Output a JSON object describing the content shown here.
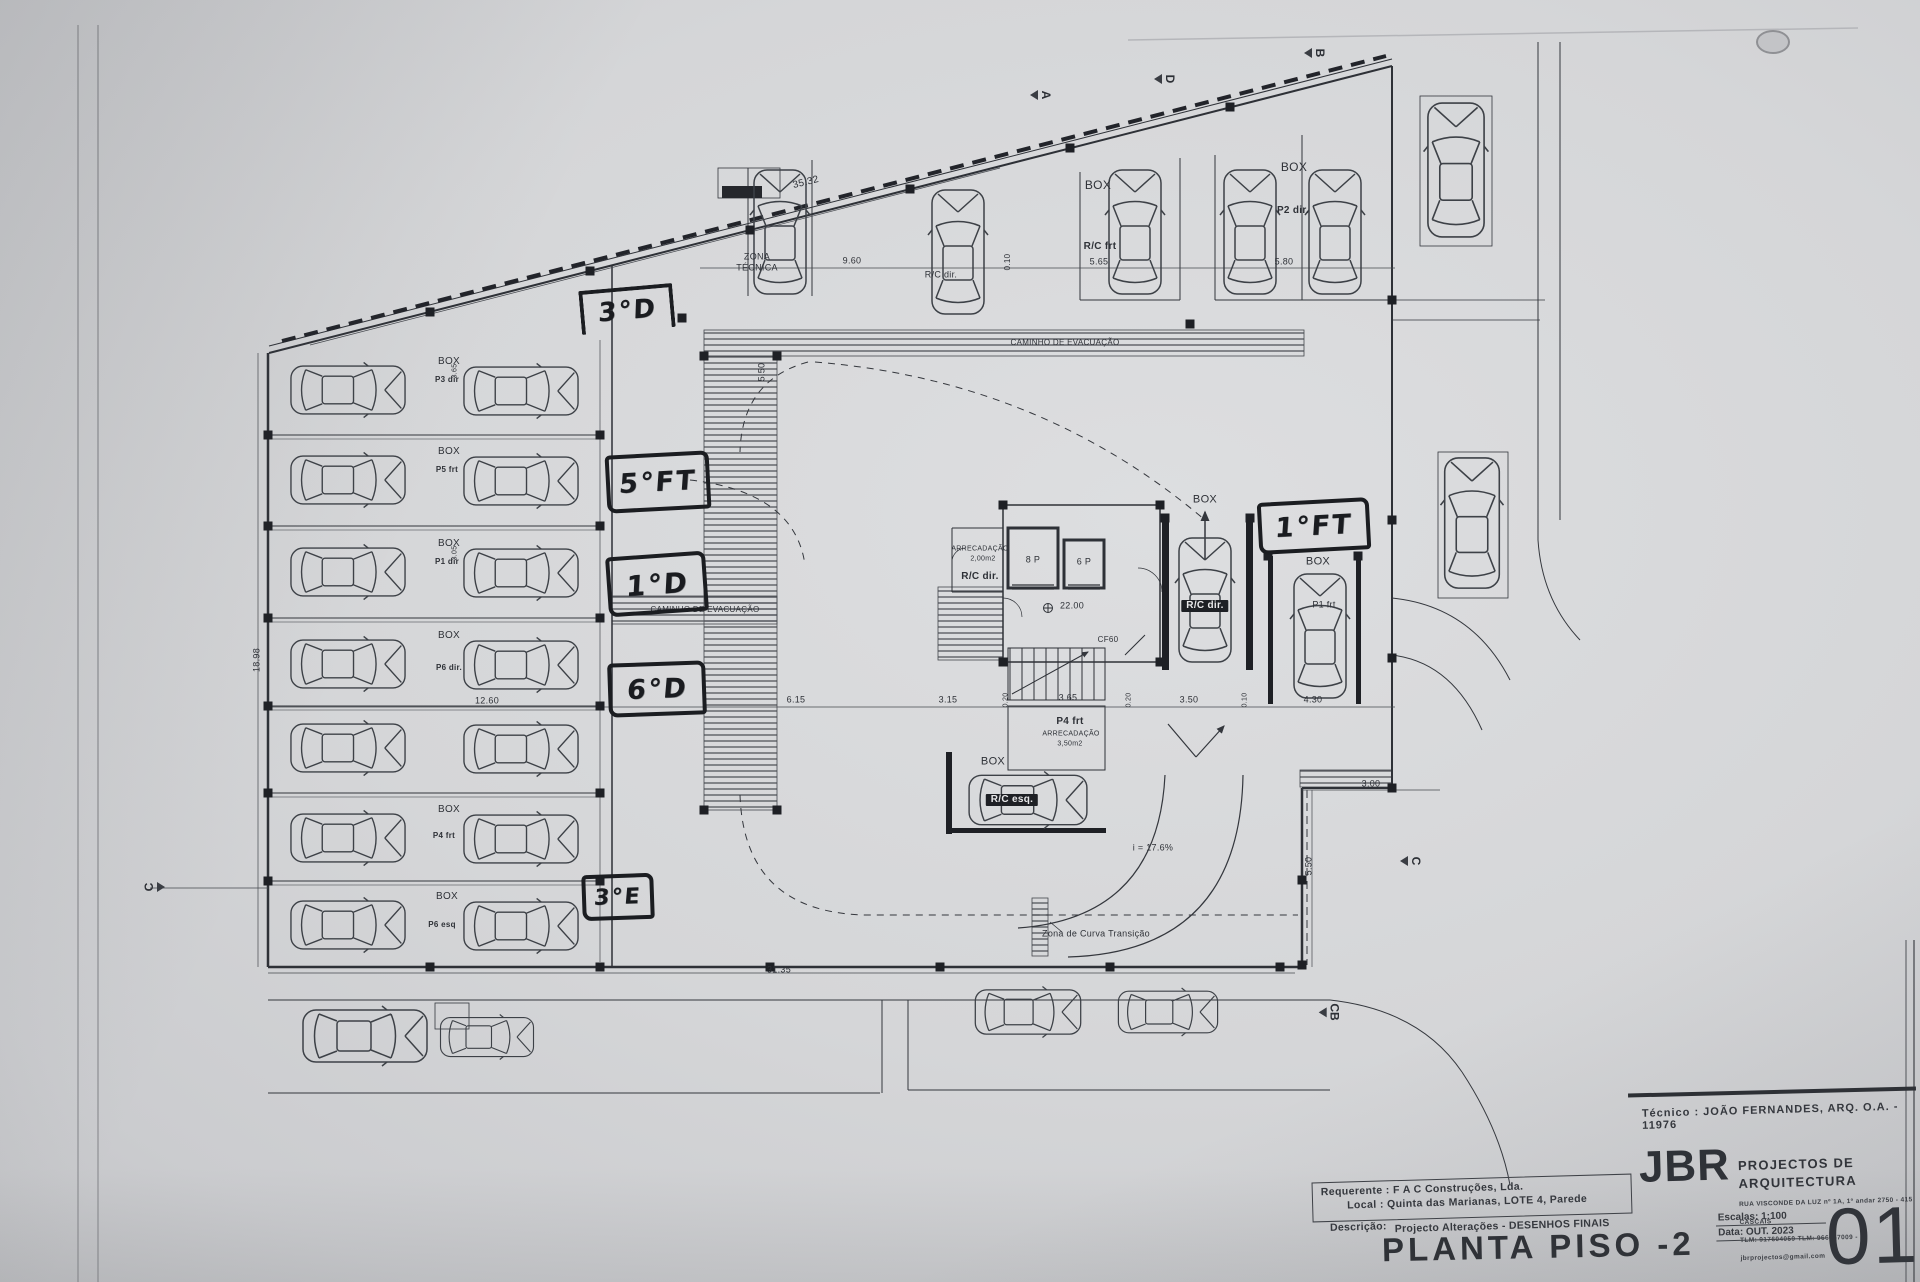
{
  "title_block": {
    "tecnico": "Técnico : JOÃO FERNANDES, ARQ.   O.A. - 11976",
    "firm_initials": "JBR",
    "firm_name": "PROJECTOS DE ARQUITECTURA",
    "firm_address": "RUA VISCONDE DA LUZ nº 1A, 1º andar  2750 - 415  CASCAIS",
    "firm_contacts": "TLM: 917604059  TLM: 966667009 - jbrprojectos@gmail.com",
    "requerente": "Requerente : F A C  Construções, Lda.",
    "local": "Local : Quinta das Marianas, LOTE 4, Parede",
    "descricao_label": "Descrição:",
    "descricao": "Projecto Alterações - DESENHOS FINAIS",
    "escala": "Escalas:  1:100",
    "data": "Data: OUT.  2023",
    "drawing_title": "PLANTA PISO -2",
    "sheet_number": "01"
  },
  "plan_labels": [
    {
      "t": "ZONA",
      "x": 757,
      "y": 257,
      "fs": 9
    },
    {
      "t": "TÉCNICA",
      "x": 757,
      "y": 268,
      "fs": 9
    },
    {
      "t": "35.32",
      "x": 806,
      "y": 183,
      "fs": 10,
      "rot": -14
    },
    {
      "t": "9.60",
      "x": 852,
      "y": 261,
      "fs": 9
    },
    {
      "t": "0.10",
      "x": 1008,
      "y": 262,
      "fs": 8,
      "rot": -90
    },
    {
      "t": "5.65",
      "x": 1099,
      "y": 262,
      "fs": 9
    },
    {
      "t": "5.80",
      "x": 1284,
      "y": 262,
      "fs": 9
    },
    {
      "t": "BOX",
      "x": 1098,
      "y": 185,
      "fs": 12
    },
    {
      "t": "R/C frt",
      "x": 1100,
      "y": 247,
      "fs": 10,
      "b": 1
    },
    {
      "t": "BOX",
      "x": 1294,
      "y": 167,
      "fs": 12
    },
    {
      "t": "P2 dir.",
      "x": 1293,
      "y": 211,
      "fs": 10,
      "b": 1
    },
    {
      "t": "R/C dir.",
      "x": 941,
      "y": 275,
      "fs": 9
    },
    {
      "t": "CAMINHO DE EVACUAÇÃO",
      "x": 1065,
      "y": 343,
      "fs": 8
    },
    {
      "t": "CAMINHO DE EVACUAÇÃO",
      "x": 705,
      "y": 610,
      "fs": 8
    },
    {
      "t": "ARRECADAÇÃO",
      "x": 980,
      "y": 549,
      "fs": 7
    },
    {
      "t": "2,00m2",
      "x": 983,
      "y": 559,
      "fs": 7
    },
    {
      "t": "R/C dir.",
      "x": 980,
      "y": 577,
      "fs": 10,
      "b": 1
    },
    {
      "t": "8 P",
      "x": 1033,
      "y": 560,
      "fs": 9
    },
    {
      "t": "6 P",
      "x": 1084,
      "y": 562,
      "fs": 9
    },
    {
      "t": "22.00",
      "x": 1072,
      "y": 606,
      "fs": 9
    },
    {
      "t": "CF60",
      "x": 1108,
      "y": 640,
      "fs": 8
    },
    {
      "t": "P4 frt",
      "x": 1070,
      "y": 722,
      "fs": 10,
      "b": 1
    },
    {
      "t": "ARRECADAÇÃO",
      "x": 1071,
      "y": 734,
      "fs": 7
    },
    {
      "t": "3,50m2",
      "x": 1070,
      "y": 744,
      "fs": 7
    },
    {
      "t": "BOX",
      "x": 993,
      "y": 762,
      "fs": 11
    },
    {
      "t": "R/C esq.",
      "x": 1012,
      "y": 800,
      "fs": 10,
      "inv": 1
    },
    {
      "t": "R/C dir.",
      "x": 1205,
      "y": 606,
      "fs": 10,
      "inv": 1
    },
    {
      "t": "BOX",
      "x": 1205,
      "y": 500,
      "fs": 11
    },
    {
      "t": "BOX",
      "x": 1318,
      "y": 562,
      "fs": 11
    },
    {
      "t": "P1 frt",
      "x": 1324,
      "y": 605,
      "fs": 9
    },
    {
      "t": "i = 17.6%",
      "x": 1153,
      "y": 848,
      "fs": 9
    },
    {
      "t": "Zona de Curva Transição",
      "x": 1096,
      "y": 934,
      "fs": 9
    },
    {
      "t": "6.15",
      "x": 796,
      "y": 700,
      "fs": 9
    },
    {
      "t": "3.15",
      "x": 948,
      "y": 700,
      "fs": 9
    },
    {
      "t": "0.20",
      "x": 1006,
      "y": 700,
      "fs": 7,
      "rot": -90
    },
    {
      "t": "3.65",
      "x": 1068,
      "y": 698,
      "fs": 9
    },
    {
      "t": "0.20",
      "x": 1129,
      "y": 700,
      "fs": 7,
      "rot": -90
    },
    {
      "t": "3.50",
      "x": 1189,
      "y": 700,
      "fs": 9
    },
    {
      "t": "0.10",
      "x": 1245,
      "y": 700,
      "fs": 7,
      "rot": -90
    },
    {
      "t": "4.30",
      "x": 1313,
      "y": 700,
      "fs": 9
    },
    {
      "t": "12.60",
      "x": 487,
      "y": 701,
      "fs": 9
    },
    {
      "t": "31.35",
      "x": 779,
      "y": 970,
      "fs": 9
    },
    {
      "t": "18.98",
      "x": 257,
      "y": 660,
      "fs": 9,
      "rot": -90
    },
    {
      "t": "5.50",
      "x": 1309,
      "y": 866,
      "fs": 9,
      "rot": -90
    },
    {
      "t": "5.50",
      "x": 762,
      "y": 372,
      "fs": 9,
      "rot": -90
    },
    {
      "t": "3.00",
      "x": 1371,
      "y": 784,
      "fs": 9
    },
    {
      "t": "BOX",
      "x": 449,
      "y": 362,
      "fs": 10
    },
    {
      "t": "BOX",
      "x": 449,
      "y": 452,
      "fs": 10
    },
    {
      "t": "BOX",
      "x": 449,
      "y": 544,
      "fs": 10
    },
    {
      "t": "BOX",
      "x": 449,
      "y": 636,
      "fs": 10
    },
    {
      "t": "BOX",
      "x": 449,
      "y": 810,
      "fs": 10
    },
    {
      "t": "BOX",
      "x": 447,
      "y": 897,
      "fs": 10
    },
    {
      "t": "P3 dir",
      "x": 447,
      "y": 380,
      "fs": 8,
      "b": 1
    },
    {
      "t": "P5 frt",
      "x": 447,
      "y": 470,
      "fs": 8,
      "b": 1
    },
    {
      "t": "P1 dir",
      "x": 447,
      "y": 562,
      "fs": 8,
      "b": 1
    },
    {
      "t": "P6 dir.",
      "x": 449,
      "y": 668,
      "fs": 8,
      "b": 1
    },
    {
      "t": "P4 frt",
      "x": 444,
      "y": 836,
      "fs": 8,
      "b": 1
    },
    {
      "t": "P6 esq",
      "x": 442,
      "y": 925,
      "fs": 8,
      "b": 1
    },
    {
      "t": "3.65",
      "x": 455,
      "y": 371,
      "fs": 7,
      "rot": -90
    },
    {
      "t": "3.05",
      "x": 455,
      "y": 553,
      "fs": 7,
      "rot": -90
    }
  ],
  "handwritten": [
    {
      "t": "3°D",
      "x": 623,
      "y": 307,
      "w": 86,
      "h": 40,
      "rot": -5,
      "style": "bars",
      "fs": 26
    },
    {
      "t": "5°FT",
      "x": 654,
      "y": 478,
      "w": 96,
      "h": 50,
      "rot": -3,
      "style": "box",
      "fs": 27
    },
    {
      "t": "1°D",
      "x": 653,
      "y": 580,
      "w": 92,
      "h": 52,
      "rot": -4,
      "style": "box",
      "fs": 28
    },
    {
      "t": "6°D",
      "x": 653,
      "y": 685,
      "w": 90,
      "h": 46,
      "rot": -2,
      "style": "box",
      "fs": 27
    },
    {
      "t": "3°E",
      "x": 614,
      "y": 893,
      "w": 64,
      "h": 38,
      "rot": -2,
      "style": "box",
      "fs": 22
    },
    {
      "t": "1°FT",
      "x": 1310,
      "y": 522,
      "w": 104,
      "h": 44,
      "rot": -3,
      "style": "box",
      "fs": 27
    }
  ],
  "section_markers": [
    {
      "t": "A",
      "x": 1044,
      "y": 96,
      "rot": 90
    },
    {
      "t": "D",
      "x": 1168,
      "y": 80,
      "rot": 90
    },
    {
      "t": "B",
      "x": 1318,
      "y": 54,
      "rot": 90
    },
    {
      "t": "C",
      "x": 157,
      "y": 888,
      "rot": -90
    },
    {
      "t": "C",
      "x": 1414,
      "y": 862,
      "rot": 90
    },
    {
      "t": "CB",
      "x": 1329,
      "y": 1013,
      "rot": 90
    }
  ],
  "cars": [
    [
      348,
      390,
      90,
      0.92
    ],
    [
      521,
      391,
      90,
      0.92
    ],
    [
      348,
      480,
      90,
      0.92
    ],
    [
      521,
      481,
      90,
      0.92
    ],
    [
      348,
      572,
      90,
      0.92
    ],
    [
      521,
      573,
      90,
      0.92
    ],
    [
      348,
      664,
      90,
      0.92
    ],
    [
      521,
      665,
      90,
      0.92
    ],
    [
      348,
      748,
      90,
      0.92
    ],
    [
      521,
      749,
      90,
      0.92
    ],
    [
      348,
      838,
      90,
      0.92
    ],
    [
      521,
      839,
      90,
      0.92
    ],
    [
      348,
      925,
      90,
      0.92
    ],
    [
      521,
      926,
      90,
      0.92
    ],
    [
      780,
      232,
      0,
      1
    ],
    [
      958,
      252,
      0,
      1
    ],
    [
      1135,
      232,
      0,
      1
    ],
    [
      1250,
      232,
      0,
      1
    ],
    [
      1335,
      232,
      0,
      1
    ],
    [
      1456,
      170,
      0,
      1.08
    ],
    [
      1472,
      523,
      0,
      1.05
    ],
    [
      1205,
      600,
      0,
      1
    ],
    [
      1320,
      636,
      0,
      1
    ],
    [
      1028,
      800,
      90,
      0.95
    ],
    [
      365,
      1036,
      90,
      1
    ],
    [
      487,
      1037,
      90,
      0.75
    ],
    [
      1028,
      1012,
      90,
      0.85
    ],
    [
      1168,
      1012,
      90,
      0.8
    ]
  ],
  "columns": [
    [
      430,
      312
    ],
    [
      590,
      271
    ],
    [
      750,
      230
    ],
    [
      910,
      189
    ],
    [
      1070,
      148
    ],
    [
      1230,
      107
    ],
    [
      268,
      435
    ],
    [
      268,
      526
    ],
    [
      268,
      618
    ],
    [
      268,
      706
    ],
    [
      268,
      793
    ],
    [
      268,
      881
    ],
    [
      600,
      435
    ],
    [
      600,
      526
    ],
    [
      600,
      618
    ],
    [
      600,
      706
    ],
    [
      600,
      793
    ],
    [
      600,
      881
    ],
    [
      430,
      967
    ],
    [
      600,
      967
    ],
    [
      770,
      967
    ],
    [
      940,
      967
    ],
    [
      1110,
      967
    ],
    [
      1280,
      967
    ],
    [
      682,
      318
    ],
    [
      1190,
      324
    ],
    [
      704,
      356
    ],
    [
      777,
      356
    ],
    [
      704,
      810
    ],
    [
      777,
      810
    ],
    [
      1003,
      505
    ],
    [
      1160,
      505
    ],
    [
      1003,
      662
    ],
    [
      1160,
      662
    ],
    [
      1165,
      518
    ],
    [
      1250,
      518
    ],
    [
      1268,
      556
    ],
    [
      1358,
      556
    ],
    [
      1392,
      300
    ],
    [
      1392,
      520
    ],
    [
      1392,
      658
    ],
    [
      1392,
      788
    ],
    [
      1302,
      880
    ],
    [
      1302,
      965
    ]
  ]
}
